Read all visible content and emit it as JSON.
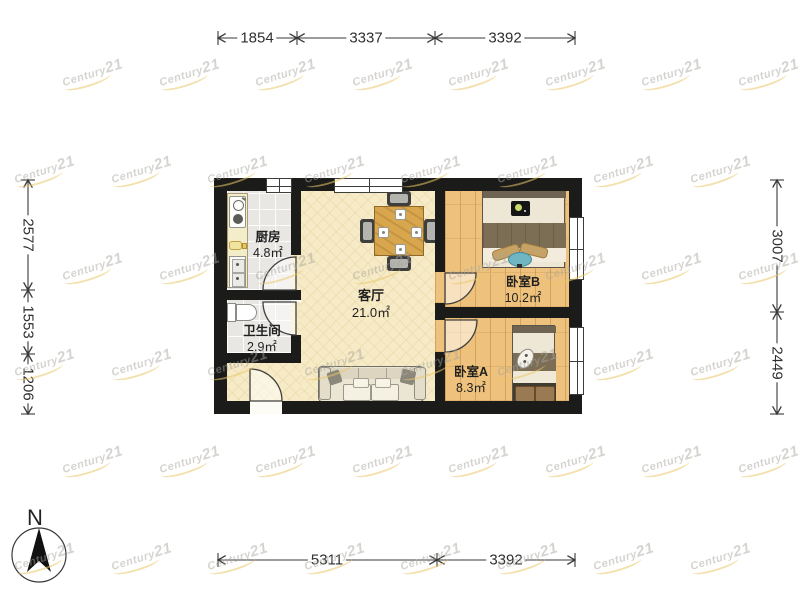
{
  "page": {
    "type": "apartment-floorplan"
  },
  "compass": {
    "label": "N"
  },
  "watermark": {
    "brand": "Century",
    "suffix": "21"
  },
  "rooms": [
    {
      "name": "厨房",
      "area": "4.8㎡"
    },
    {
      "name": "卫生间",
      "area": "2.9㎡"
    },
    {
      "name": "客厅",
      "area": "21.0㎡"
    },
    {
      "name": "卧室B",
      "area": "10.2㎡"
    },
    {
      "name": "卧室A",
      "area": "8.3㎡"
    }
  ],
  "dimensions_mm": {
    "top": [
      "1854",
      "3337",
      "3392"
    ],
    "bottom": [
      "5311",
      "3392"
    ],
    "left": [
      "2577",
      "1553",
      "1206"
    ],
    "right": [
      "3007",
      "2449"
    ]
  },
  "colors": {
    "wall": "#1b1b19",
    "wood_floor": "#eec27c",
    "living_floor": "#f6ebc6",
    "tile_floor": "#e8e7e4",
    "table_wood": "#d8a64c",
    "watermark_gold": "#e9c76a",
    "stool_blue": "#6fb5c2"
  }
}
